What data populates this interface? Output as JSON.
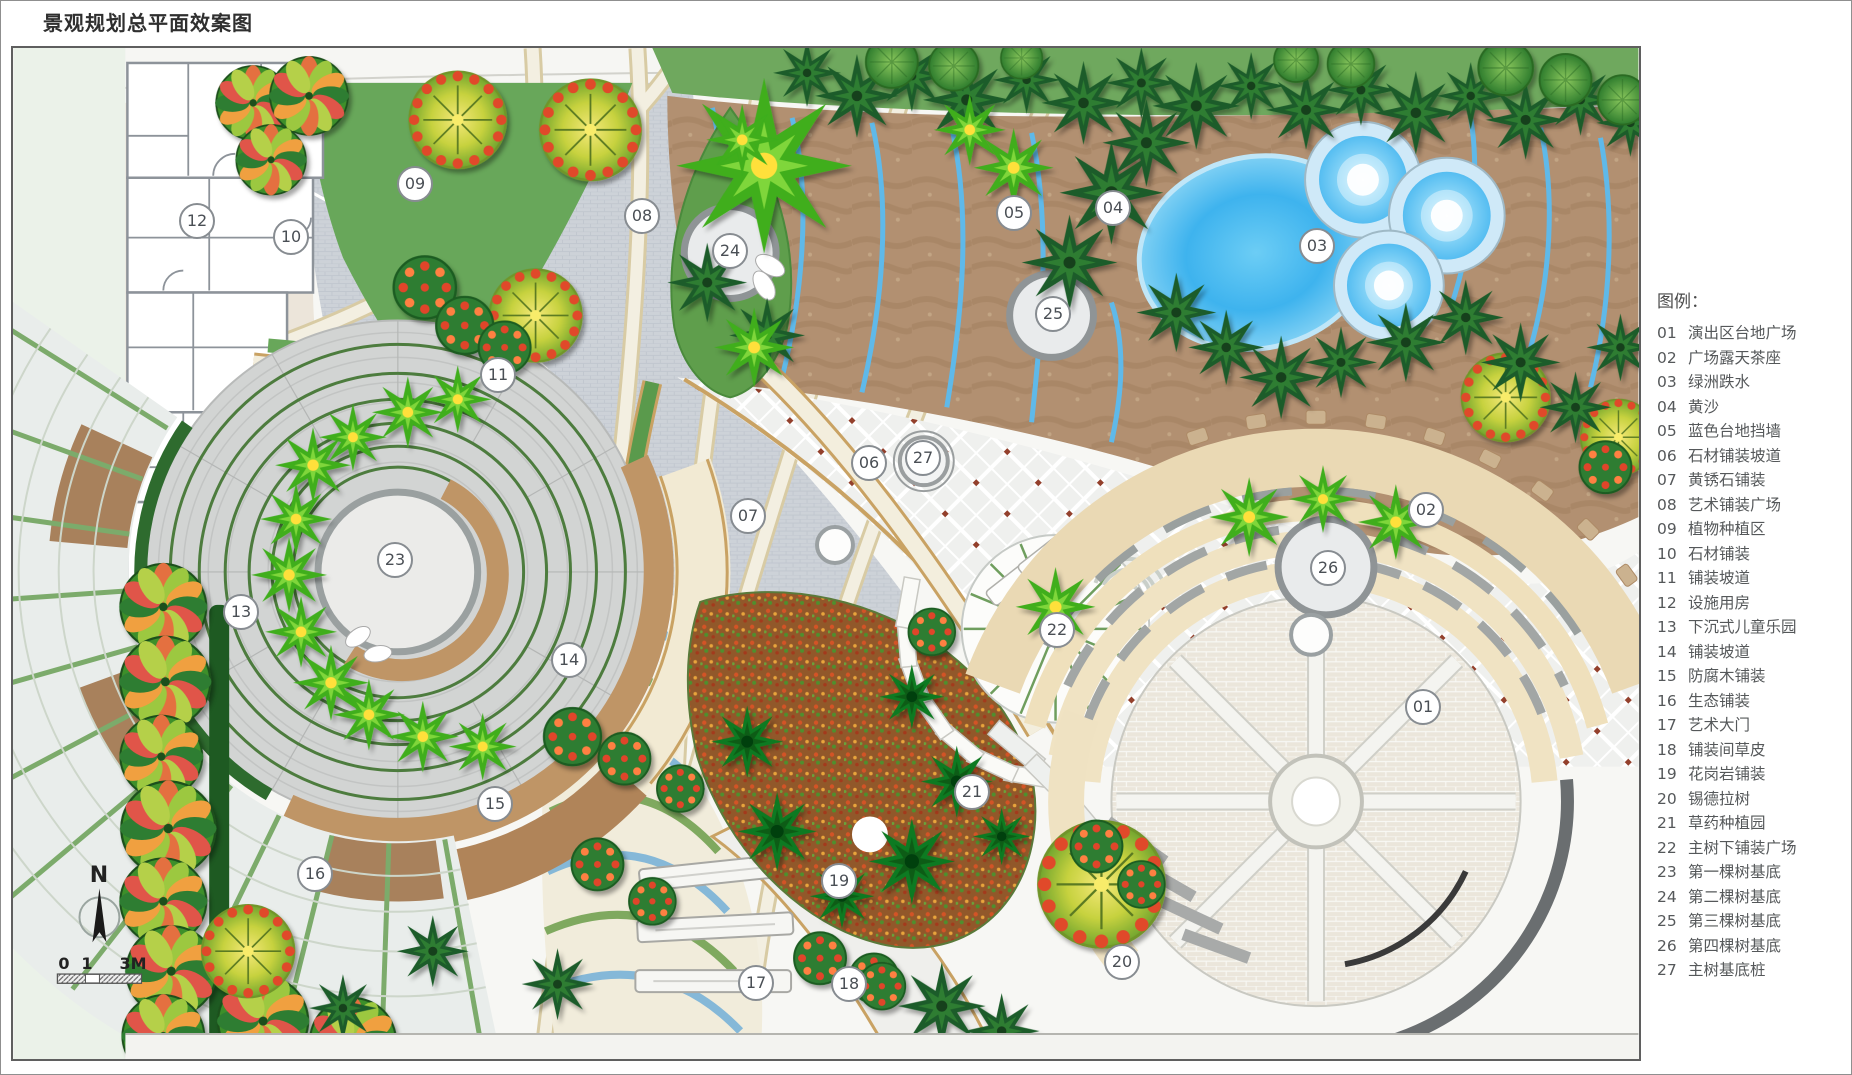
{
  "title": "景观规划总平面效案图",
  "legend": {
    "title": "图例：",
    "items": [
      {
        "num": "01",
        "label": "演出区台地广场"
      },
      {
        "num": "02",
        "label": "广场露天茶座"
      },
      {
        "num": "03",
        "label": "绿洲跌水"
      },
      {
        "num": "04",
        "label": "黄沙"
      },
      {
        "num": "05",
        "label": "蓝色台地挡墙"
      },
      {
        "num": "06",
        "label": "石材铺装坡道"
      },
      {
        "num": "07",
        "label": "黄锈石铺装"
      },
      {
        "num": "08",
        "label": "艺术铺装广场"
      },
      {
        "num": "09",
        "label": "植物种植区"
      },
      {
        "num": "10",
        "label": "石材铺装"
      },
      {
        "num": "11",
        "label": "铺装坡道"
      },
      {
        "num": "12",
        "label": "设施用房"
      },
      {
        "num": "13",
        "label": "下沉式儿童乐园"
      },
      {
        "num": "14",
        "label": "铺装坡道"
      },
      {
        "num": "15",
        "label": "防腐木铺装"
      },
      {
        "num": "16",
        "label": "生态铺装"
      },
      {
        "num": "17",
        "label": "艺术大门"
      },
      {
        "num": "18",
        "label": "铺装间草皮"
      },
      {
        "num": "19",
        "label": "花岗岩铺装"
      },
      {
        "num": "20",
        "label": "锡德拉树"
      },
      {
        "num": "21",
        "label": "草药种植园"
      },
      {
        "num": "22",
        "label": "主树下铺装广场"
      },
      {
        "num": "23",
        "label": "第一棵树基底"
      },
      {
        "num": "24",
        "label": "第二棵树基底"
      },
      {
        "num": "25",
        "label": "第三棵树基底"
      },
      {
        "num": "26",
        "label": "第四棵树基底"
      },
      {
        "num": "27",
        "label": "主树基底桩"
      }
    ]
  },
  "compass": {
    "north_label": "N",
    "scale_labels": [
      "0",
      "1",
      "3M"
    ]
  },
  "markers": [
    {
      "num": "01",
      "x": 1410,
      "y": 659
    },
    {
      "num": "02",
      "x": 1413,
      "y": 462
    },
    {
      "num": "03",
      "x": 1304,
      "y": 198
    },
    {
      "num": "04",
      "x": 1100,
      "y": 160
    },
    {
      "num": "05",
      "x": 1001,
      "y": 165
    },
    {
      "num": "06",
      "x": 856,
      "y": 415
    },
    {
      "num": "07",
      "x": 735,
      "y": 468
    },
    {
      "num": "08",
      "x": 629,
      "y": 168
    },
    {
      "num": "09",
      "x": 402,
      "y": 136
    },
    {
      "num": "10",
      "x": 278,
      "y": 189
    },
    {
      "num": "11",
      "x": 485,
      "y": 327
    },
    {
      "num": "12",
      "x": 184,
      "y": 173
    },
    {
      "num": "13",
      "x": 228,
      "y": 564
    },
    {
      "num": "14",
      "x": 556,
      "y": 612
    },
    {
      "num": "15",
      "x": 482,
      "y": 756
    },
    {
      "num": "16",
      "x": 302,
      "y": 826
    },
    {
      "num": "17",
      "x": 743,
      "y": 935
    },
    {
      "num": "18",
      "x": 836,
      "y": 936
    },
    {
      "num": "19",
      "x": 826,
      "y": 833
    },
    {
      "num": "20",
      "x": 1109,
      "y": 914
    },
    {
      "num": "21",
      "x": 959,
      "y": 744
    },
    {
      "num": "22",
      "x": 1044,
      "y": 582
    },
    {
      "num": "23",
      "x": 382,
      "y": 512
    },
    {
      "num": "24",
      "x": 717,
      "y": 203
    },
    {
      "num": "25",
      "x": 1040,
      "y": 266
    },
    {
      "num": "26",
      "x": 1315,
      "y": 520
    },
    {
      "num": "27",
      "x": 910,
      "y": 410
    }
  ],
  "colors": {
    "mint_strip": "#ebf2e9",
    "plaza_gray": "#cdd2d8",
    "planting_green": "#68a75a",
    "sand": "#b29071",
    "water_blue": "#3fb0ee",
    "terrace_wall_blue": "#5fb9e9",
    "cream_path": "#f3efe1",
    "path_edge": "#c9a263",
    "amphi_cream": "#f0e3c3",
    "step_gray": "#a2a6a5",
    "herb_base": "#91582a",
    "ring_green": "#4d7c3e",
    "wood_brown": "#b08459",
    "marker_border": "#878c91"
  }
}
